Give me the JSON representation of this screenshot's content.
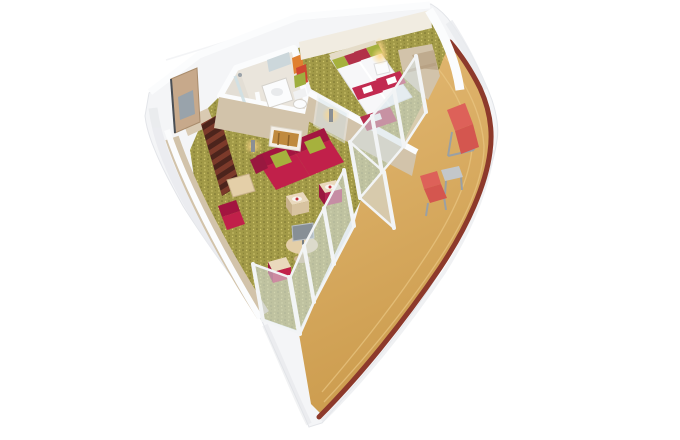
{
  "scene": {
    "kind": "3d-cutaway-rendering",
    "subject": "cruise-ship-balcony-suite",
    "rooms": [
      "entry-corridor",
      "bathroom",
      "bedroom",
      "living-room",
      "wardrobe-nook",
      "wraparound-balcony"
    ],
    "furniture": [
      "entry-door",
      "shower",
      "vanity-sink",
      "toilet",
      "twin-beds",
      "nightstand-lamp",
      "foot-bench",
      "wardrobe",
      "red-sofa",
      "green-pillows",
      "wall-artwork",
      "wall-sconces",
      "cube-side-tables",
      "round-media-table",
      "tv-screen",
      "desk",
      "red-desk-chair",
      "red-ottoman",
      "glass-balcony-doors",
      "sun-lounger",
      "balcony-side-table",
      "balcony-chair"
    ]
  },
  "colors": {
    "background": "#ffffff",
    "hull_white": "#f4f5f7",
    "hull_edge": "#e3e5e9",
    "wall_top_white": "#fbfcfd",
    "wall_wood": "#d2c3aa",
    "wall_wood_dark": "#bfab8e",
    "back_wall_cream": "#f1ece1",
    "carpet_green": "#a29a48",
    "corridor_stripe_a": "#7c3a2a",
    "corridor_stripe_b": "#4c241c",
    "deck_light": "#e4ba74",
    "deck_dark": "#cc9c4e",
    "trim_maroon": "#8d392b",
    "sofa_red": "#c1204a",
    "sofa_red_dark": "#a31540",
    "pillow_green": "#a6b13d",
    "bed_white": "#f7f7f9",
    "runner_red": "#c22a50",
    "bench_red": "#b52e4e",
    "lounger_red": "#dd6159",
    "lounger_red_dark": "#d4564f",
    "glass_blue": "#d7e4e9",
    "frame_white": "#f2f4f5",
    "mullion_dark": "#6f665c",
    "artwork_amber": "#c08a3e",
    "lamp_glow": "#ffd98a",
    "towel_orange": "#e08030",
    "towel_red": "#cf4632",
    "towel_green": "#9fae3e",
    "fixture_white": "#fbfcfd",
    "screen_gray": "#878f96",
    "table_wood": "#e4cfa8",
    "cube_magenta": "#b32450",
    "door_wood": "#c7a98b",
    "door_panel": "#99a3ab",
    "metal_gray": "#c3c7ca",
    "bathroom_floor": "#eae5dc"
  }
}
